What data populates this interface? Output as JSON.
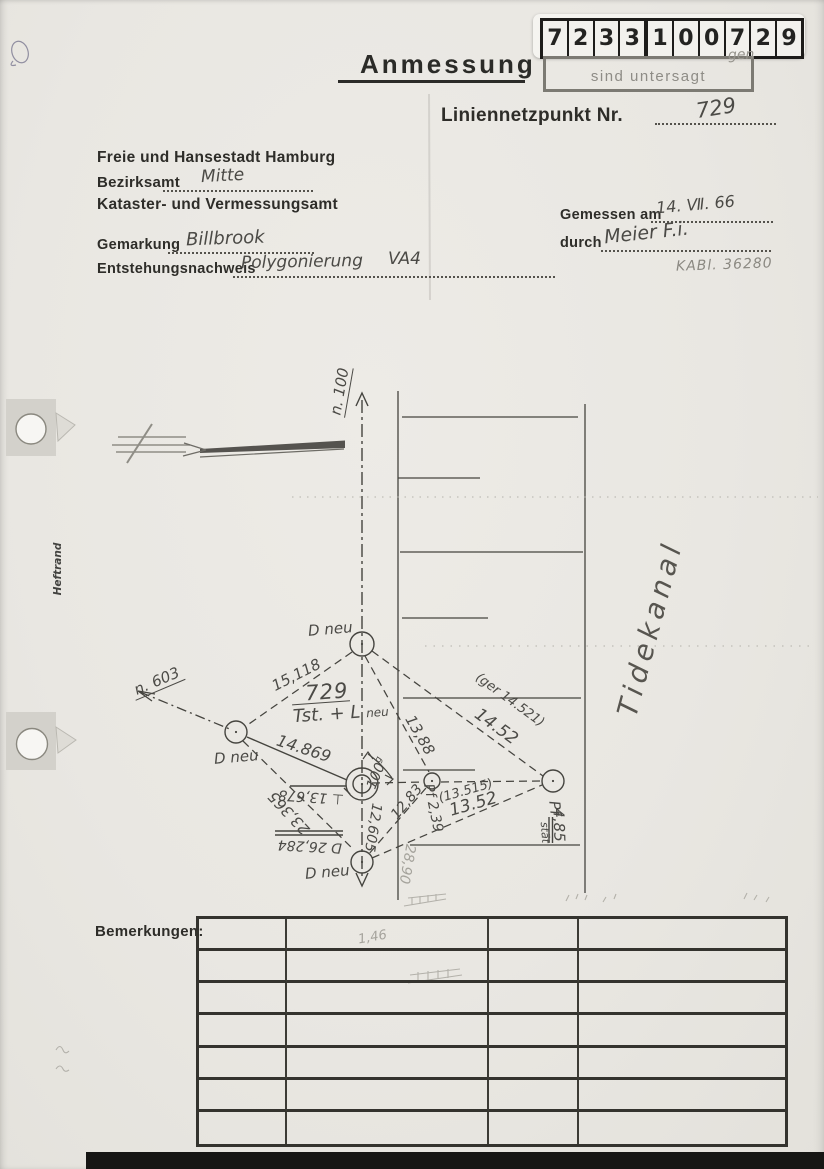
{
  "header": {
    "title": "Anmessung",
    "sticker_digits": [
      "7",
      "2",
      "3",
      "3",
      "1",
      "0",
      "0",
      "7",
      "2",
      "9"
    ],
    "stamp_fragment": "gen",
    "stamp_text": "sind untersagt",
    "point_label": "Liniennetzpunkt Nr.",
    "point_number": "729"
  },
  "form": {
    "org_line1": "Freie und Hansestadt Hamburg",
    "bezirksamt_label": "Bezirksamt",
    "bezirksamt_value": "Mitte",
    "org_line2": "Kataster- und Vermessungsamt",
    "gemarkung_label": "Gemarkung",
    "gemarkung_value": "Billbrook",
    "entstehung_label": "Entstehungsnachweis",
    "entstehung_value": "Polygonierung",
    "entstehung_value2": "VA4",
    "gemessen_label": "Gemessen am",
    "gemessen_value": "14. Ⅶ. 66",
    "durch_label": "durch",
    "durch_value": "Meier F.i.",
    "kabl_note": "KABl. 36280"
  },
  "margin": {
    "heftrand": "Heftrand"
  },
  "sketch": {
    "axis_north": "n. 100",
    "axis_west": "n. 603",
    "canal_name": "Tidekanal",
    "node_top_label": "D neu",
    "node_left_label": "D neu",
    "node_bottom_label": "D neu",
    "point_id": "729",
    "point_desc": "Tst. + L",
    "point_desc_suffix": "neu",
    "meas_top_left": "15,118",
    "meas_left_center": "14.869",
    "meas_left_bottom": "23,365",
    "meas_top_small": "13,88",
    "meas_top_right_paren": "(ger 14.521)",
    "meas_top_right": "14.52",
    "meas_small_bottom": "12,83",
    "meas_pf": "Pf 2,39",
    "meas_center_right_paren": "(13.515)",
    "meas_center_right": "13.52",
    "meas_center_bottom": "12,605",
    "meas_perp": "⊥ 13,678",
    "meas_d": "D 26,284",
    "angle_value": "100",
    "angle_unit": "g",
    "pf_right": "Pf",
    "pf_right_word": "stät",
    "pf_right_value": "4,85",
    "pencil_28": "28,90",
    "pencil_146": "1,46"
  },
  "footer": {
    "bemerkungen_label": "Bemerkungen:"
  }
}
